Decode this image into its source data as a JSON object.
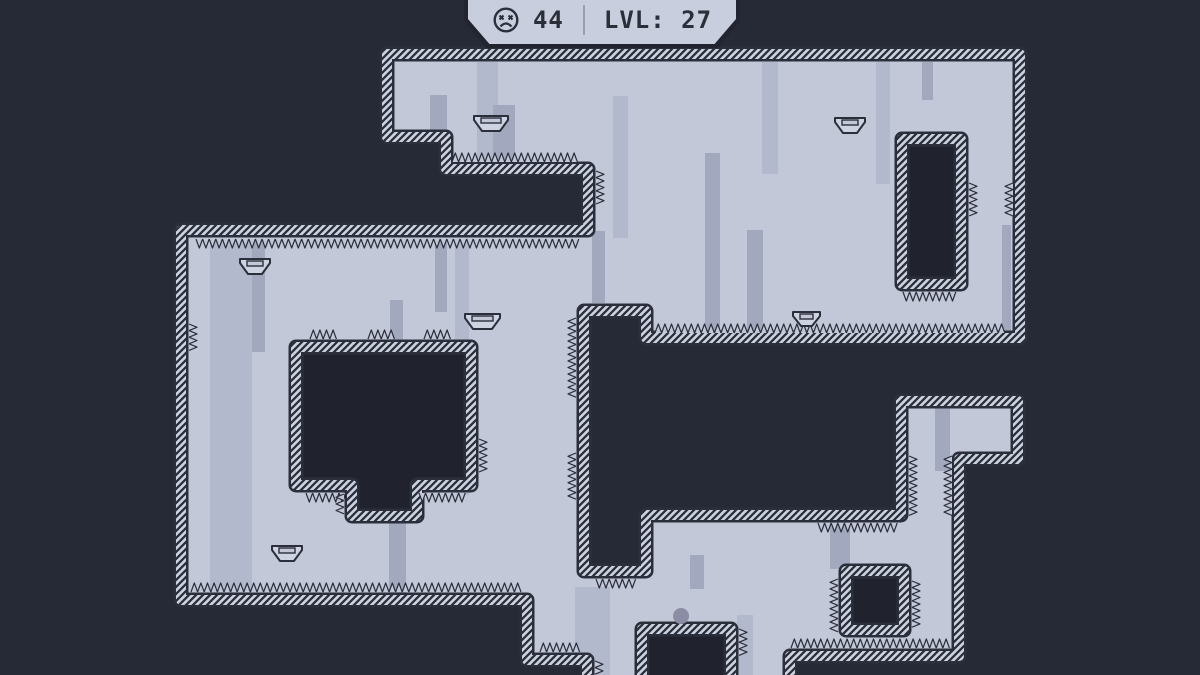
{
  "hud": {
    "deaths": "44",
    "level": "LVL: 27",
    "icon": "dead-face-icon"
  },
  "colors": {
    "bg": "#262a36",
    "hole": "#20232e",
    "floor": "#c3c8d9",
    "band": "#ced3e1",
    "line": "#2b2f3b",
    "pillarA": "#b3b9cc",
    "pillarB": "#a2a9bf",
    "ball": "#8a8da3",
    "hud_fill": "#c9cede",
    "hud_border": "#22252f",
    "divider": "#99a0b3",
    "text": "#2b2f3a"
  },
  "level": {
    "outline": [
      [
        387,
        54
      ],
      [
        1020,
        54
      ],
      [
        1020,
        338
      ],
      [
        646,
        338
      ],
      [
        646,
        311
      ],
      [
        584,
        311
      ],
      [
        584,
        571
      ],
      [
        646,
        571
      ],
      [
        646,
        515
      ],
      [
        901,
        515
      ],
      [
        901,
        401
      ],
      [
        1018,
        401
      ],
      [
        1018,
        459
      ],
      [
        959,
        459
      ],
      [
        959,
        656
      ],
      [
        790,
        656
      ],
      [
        790,
        686
      ],
      [
        587,
        686
      ],
      [
        587,
        660
      ],
      [
        527,
        660
      ],
      [
        527,
        600
      ],
      [
        181,
        600
      ],
      [
        181,
        230
      ],
      [
        588,
        230
      ],
      [
        588,
        169
      ],
      [
        446,
        169
      ],
      [
        446,
        137
      ],
      [
        387,
        137
      ]
    ],
    "holes": [
      {
        "name": "hole-top-right",
        "pts": [
          [
            902,
            139
          ],
          [
            961,
            139
          ],
          [
            961,
            284
          ],
          [
            902,
            284
          ]
        ]
      },
      {
        "name": "hole-left",
        "pts": [
          [
            296,
            347
          ],
          [
            471,
            347
          ],
          [
            471,
            485
          ],
          [
            417,
            485
          ],
          [
            417,
            516
          ],
          [
            352,
            516
          ],
          [
            352,
            485
          ],
          [
            296,
            485
          ]
        ]
      },
      {
        "name": "hole-square-right",
        "pts": [
          [
            846,
            571
          ],
          [
            904,
            571
          ],
          [
            904,
            630
          ],
          [
            846,
            630
          ]
        ]
      },
      {
        "name": "hole-bottom",
        "pts": [
          [
            642,
            629
          ],
          [
            731,
            629
          ],
          [
            731,
            692
          ],
          [
            642,
            692
          ]
        ]
      }
    ],
    "pillars": [
      [
        430,
        95,
        17,
        62,
        "b"
      ],
      [
        477,
        62,
        21,
        100,
        "a"
      ],
      [
        493,
        105,
        22,
        60,
        "b"
      ],
      [
        613,
        96,
        15,
        142,
        "a"
      ],
      [
        705,
        153,
        15,
        180,
        "b"
      ],
      [
        762,
        62,
        16,
        112,
        "a"
      ],
      [
        747,
        230,
        16,
        105,
        "b"
      ],
      [
        876,
        62,
        14,
        122,
        "a"
      ],
      [
        922,
        62,
        11,
        38,
        "b"
      ],
      [
        1002,
        225,
        9,
        110,
        "b"
      ],
      [
        592,
        231,
        13,
        72,
        "b"
      ],
      [
        210,
        240,
        42,
        358,
        "a"
      ],
      [
        252,
        240,
        13,
        112,
        "b"
      ],
      [
        390,
        300,
        13,
        292,
        "b"
      ],
      [
        435,
        240,
        12,
        72,
        "b"
      ],
      [
        455,
        240,
        14,
        255,
        "a"
      ],
      [
        389,
        522,
        17,
        75,
        "b"
      ],
      [
        575,
        587,
        35,
        90,
        "a"
      ],
      [
        690,
        555,
        14,
        34,
        "b"
      ],
      [
        737,
        615,
        16,
        62,
        "a"
      ],
      [
        830,
        522,
        20,
        47,
        "b"
      ],
      [
        935,
        408,
        15,
        63,
        "b"
      ]
    ],
    "spikes": [
      [
        "u",
        452,
        162,
        128
      ],
      [
        "u",
        655,
        333,
        352
      ],
      [
        "u",
        310,
        339,
        28
      ],
      [
        "u",
        368,
        339,
        28
      ],
      [
        "u",
        424,
        339,
        28
      ],
      [
        "u",
        540,
        652,
        42
      ],
      [
        "u",
        791,
        648,
        156
      ],
      [
        "u",
        191,
        592,
        332
      ],
      [
        "d",
        196,
        239,
        384
      ],
      [
        "d",
        903,
        292,
        56
      ],
      [
        "d",
        306,
        493,
        42
      ],
      [
        "d",
        419,
        493,
        49
      ],
      [
        "d",
        596,
        579,
        40
      ],
      [
        "d",
        818,
        523,
        76
      ],
      [
        "l",
        952,
        456,
        58
      ],
      [
        "l",
        1013,
        183,
        31
      ],
      [
        "l",
        576,
        318,
        80
      ],
      [
        "l",
        576,
        453,
        46
      ],
      [
        "l",
        838,
        579,
        50
      ],
      [
        "l",
        344,
        494,
        22
      ],
      [
        "r",
        189,
        324,
        27
      ],
      [
        "r",
        479,
        439,
        35
      ],
      [
        "r",
        969,
        183,
        30
      ],
      [
        "r",
        596,
        171,
        33
      ],
      [
        "r",
        909,
        456,
        58
      ],
      [
        "r",
        912,
        581,
        45
      ],
      [
        "r",
        739,
        629,
        24
      ],
      [
        "r",
        595,
        661,
        15
      ]
    ],
    "ledges": [
      [
        474,
        116,
        34,
        15
      ],
      [
        835,
        118,
        30,
        15
      ],
      [
        240,
        259,
        30,
        15
      ],
      [
        465,
        314,
        35,
        15
      ],
      [
        793,
        312,
        27,
        14
      ],
      [
        272,
        546,
        30,
        15
      ]
    ],
    "ball": {
      "x": 681,
      "y": 616,
      "r": 8
    }
  }
}
